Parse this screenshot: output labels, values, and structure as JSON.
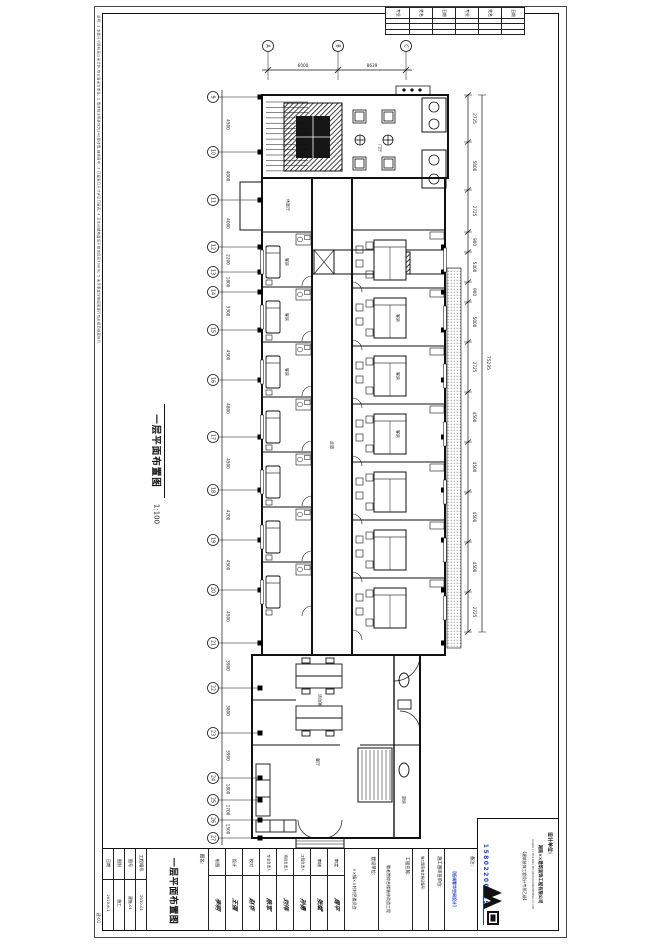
{
  "sheet": {
    "drawing_title": "一层平面布置图",
    "scale": "1:100",
    "page_label": "建-01",
    "notes": "说明: 1.本图尺寸除标高以米计外,均以毫米为单位; 2.墙体除注明外均为240厚砖墙,轴线居中; 3.门窗洞口尺寸详见门窗表; 4.卫生间楼地面低于相邻房间30mm; 5.未尽事宜均按国家现行有关规范规程执行."
  },
  "revision_table": {
    "headers": [
      "专业",
      "姓名",
      "日期",
      "专业",
      "姓名",
      "日期"
    ]
  },
  "axes": {
    "left_bubbles": [
      "9",
      "10",
      "11",
      "12",
      "13",
      "14",
      "15",
      "16",
      "17",
      "18",
      "19",
      "20",
      "21",
      "22",
      "23",
      "24",
      "25",
      "26",
      "27"
    ],
    "left_dims": [
      "4500",
      "4000",
      "4000",
      "2200",
      "1800",
      "3300",
      "4500",
      "4800",
      "4500",
      "4200",
      "4500",
      "4500",
      "3900",
      "3800",
      "3900",
      "1800",
      "1700",
      "1500"
    ],
    "top_bubbles": [
      "A",
      "B",
      "C"
    ],
    "top_dims": [
      "6000",
      "8639"
    ],
    "right_dims": [
      "2725",
      "5000",
      "2725",
      "900",
      "5400",
      "900",
      "5000",
      "2725",
      "4500",
      "4500",
      "4500",
      "4500",
      "2725"
    ],
    "right_total": "75235"
  },
  "plan": {
    "rooms": [
      "门厅",
      "休息厅",
      "客房",
      "客房",
      "客房",
      "客房",
      "客房",
      "客房",
      "走道",
      "活动室",
      "餐厅",
      "厨房"
    ]
  },
  "title_block": {
    "name_label": "图名:",
    "drawing_name": "一层平面布置图",
    "fields": [
      {
        "label": "日期",
        "value": "2010-6-1"
      },
      {
        "label": "图别",
        "value": "施工"
      },
      {
        "label": "图号",
        "value": "建施-01"
      },
      {
        "label": "工程编号",
        "value": "2010-01"
      }
    ],
    "signatures": [
      {
        "role": "制图",
        "name": "李明"
      },
      {
        "role": "设计",
        "name": "王强"
      },
      {
        "role": "校对",
        "name": "赵华"
      },
      {
        "role": "专业负责人",
        "name": "陈军"
      },
      {
        "role": "项目负责人",
        "name": "刘伟"
      },
      {
        "role": "工程负责人",
        "name": "孙勇"
      },
      {
        "role": "审核",
        "name": "张斌"
      },
      {
        "role": "审定",
        "name": "周平"
      }
    ],
    "right_fields": [
      {
        "label": "建设单位:",
        "value": "××镇××村村民委员会"
      },
      {
        "label": "工程名称:",
        "value": "敬老院综合楼装修改造工程"
      },
      {
        "label": "施工图审查合格证编号:",
        "value": ""
      },
      {
        "label": "施工图审查单位:",
        "value": ""
      },
      {
        "label": "备注:",
        "value": "【低调奢华空间设计】"
      }
    ],
    "design_unit": {
      "label": "设计单位:",
      "company": "湖南××建筑装饰工程有限公司",
      "company_en": "HUNAN ×× BUILDING DECORATION ENGINEERING CO.,LTD",
      "qualification": "【建筑装饰工程设计专项乙级】",
      "phone": "15802200959"
    },
    "colors": {
      "accent_blue": "#1d3fd0",
      "line": "#111111"
    }
  }
}
